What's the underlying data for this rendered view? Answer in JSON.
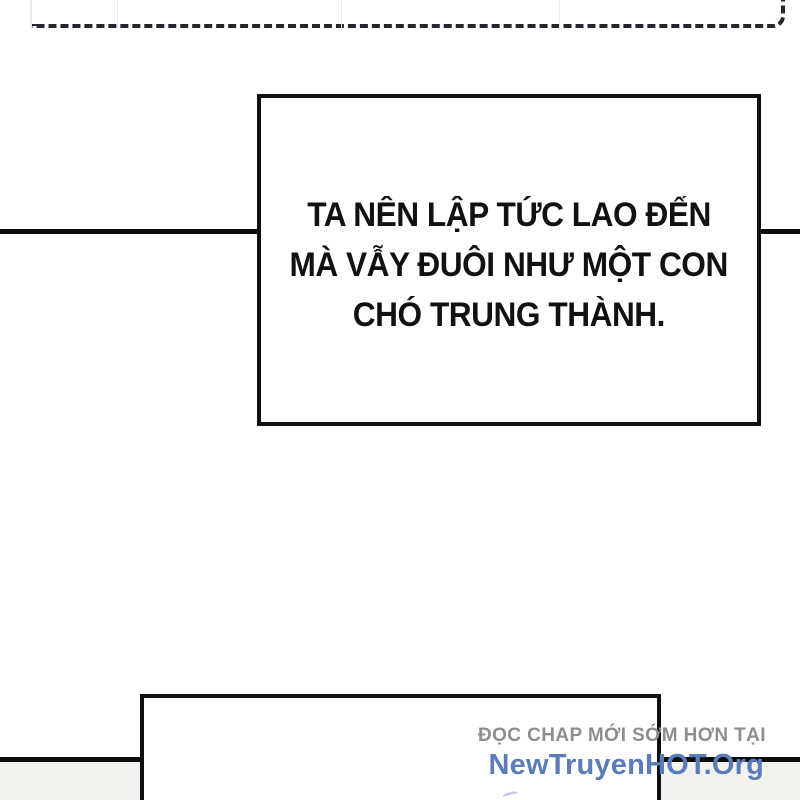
{
  "speech_bubble": {
    "lines": [
      "TA NÊN LẬP TỨC LAO ĐẾN",
      "MÀ VẪY ĐUÔI NHƯ MỘT CON",
      "CHÓ TRUNG THÀNH."
    ]
  },
  "watermark": {
    "tagline": "ĐỌC CHAP MỚI SỚM HƠN TẠI",
    "site": "NewTruyenHOT.Org"
  },
  "colors": {
    "dash-color": "#23272d",
    "line-color": "#0c0c0c",
    "bubble-border": "#0f0f0f",
    "strip-bg": "#f3f2ee",
    "faint-line": "#e9ebec",
    "wm-gray": "#8e8e8e",
    "wm-blue": "#5b7cba"
  }
}
